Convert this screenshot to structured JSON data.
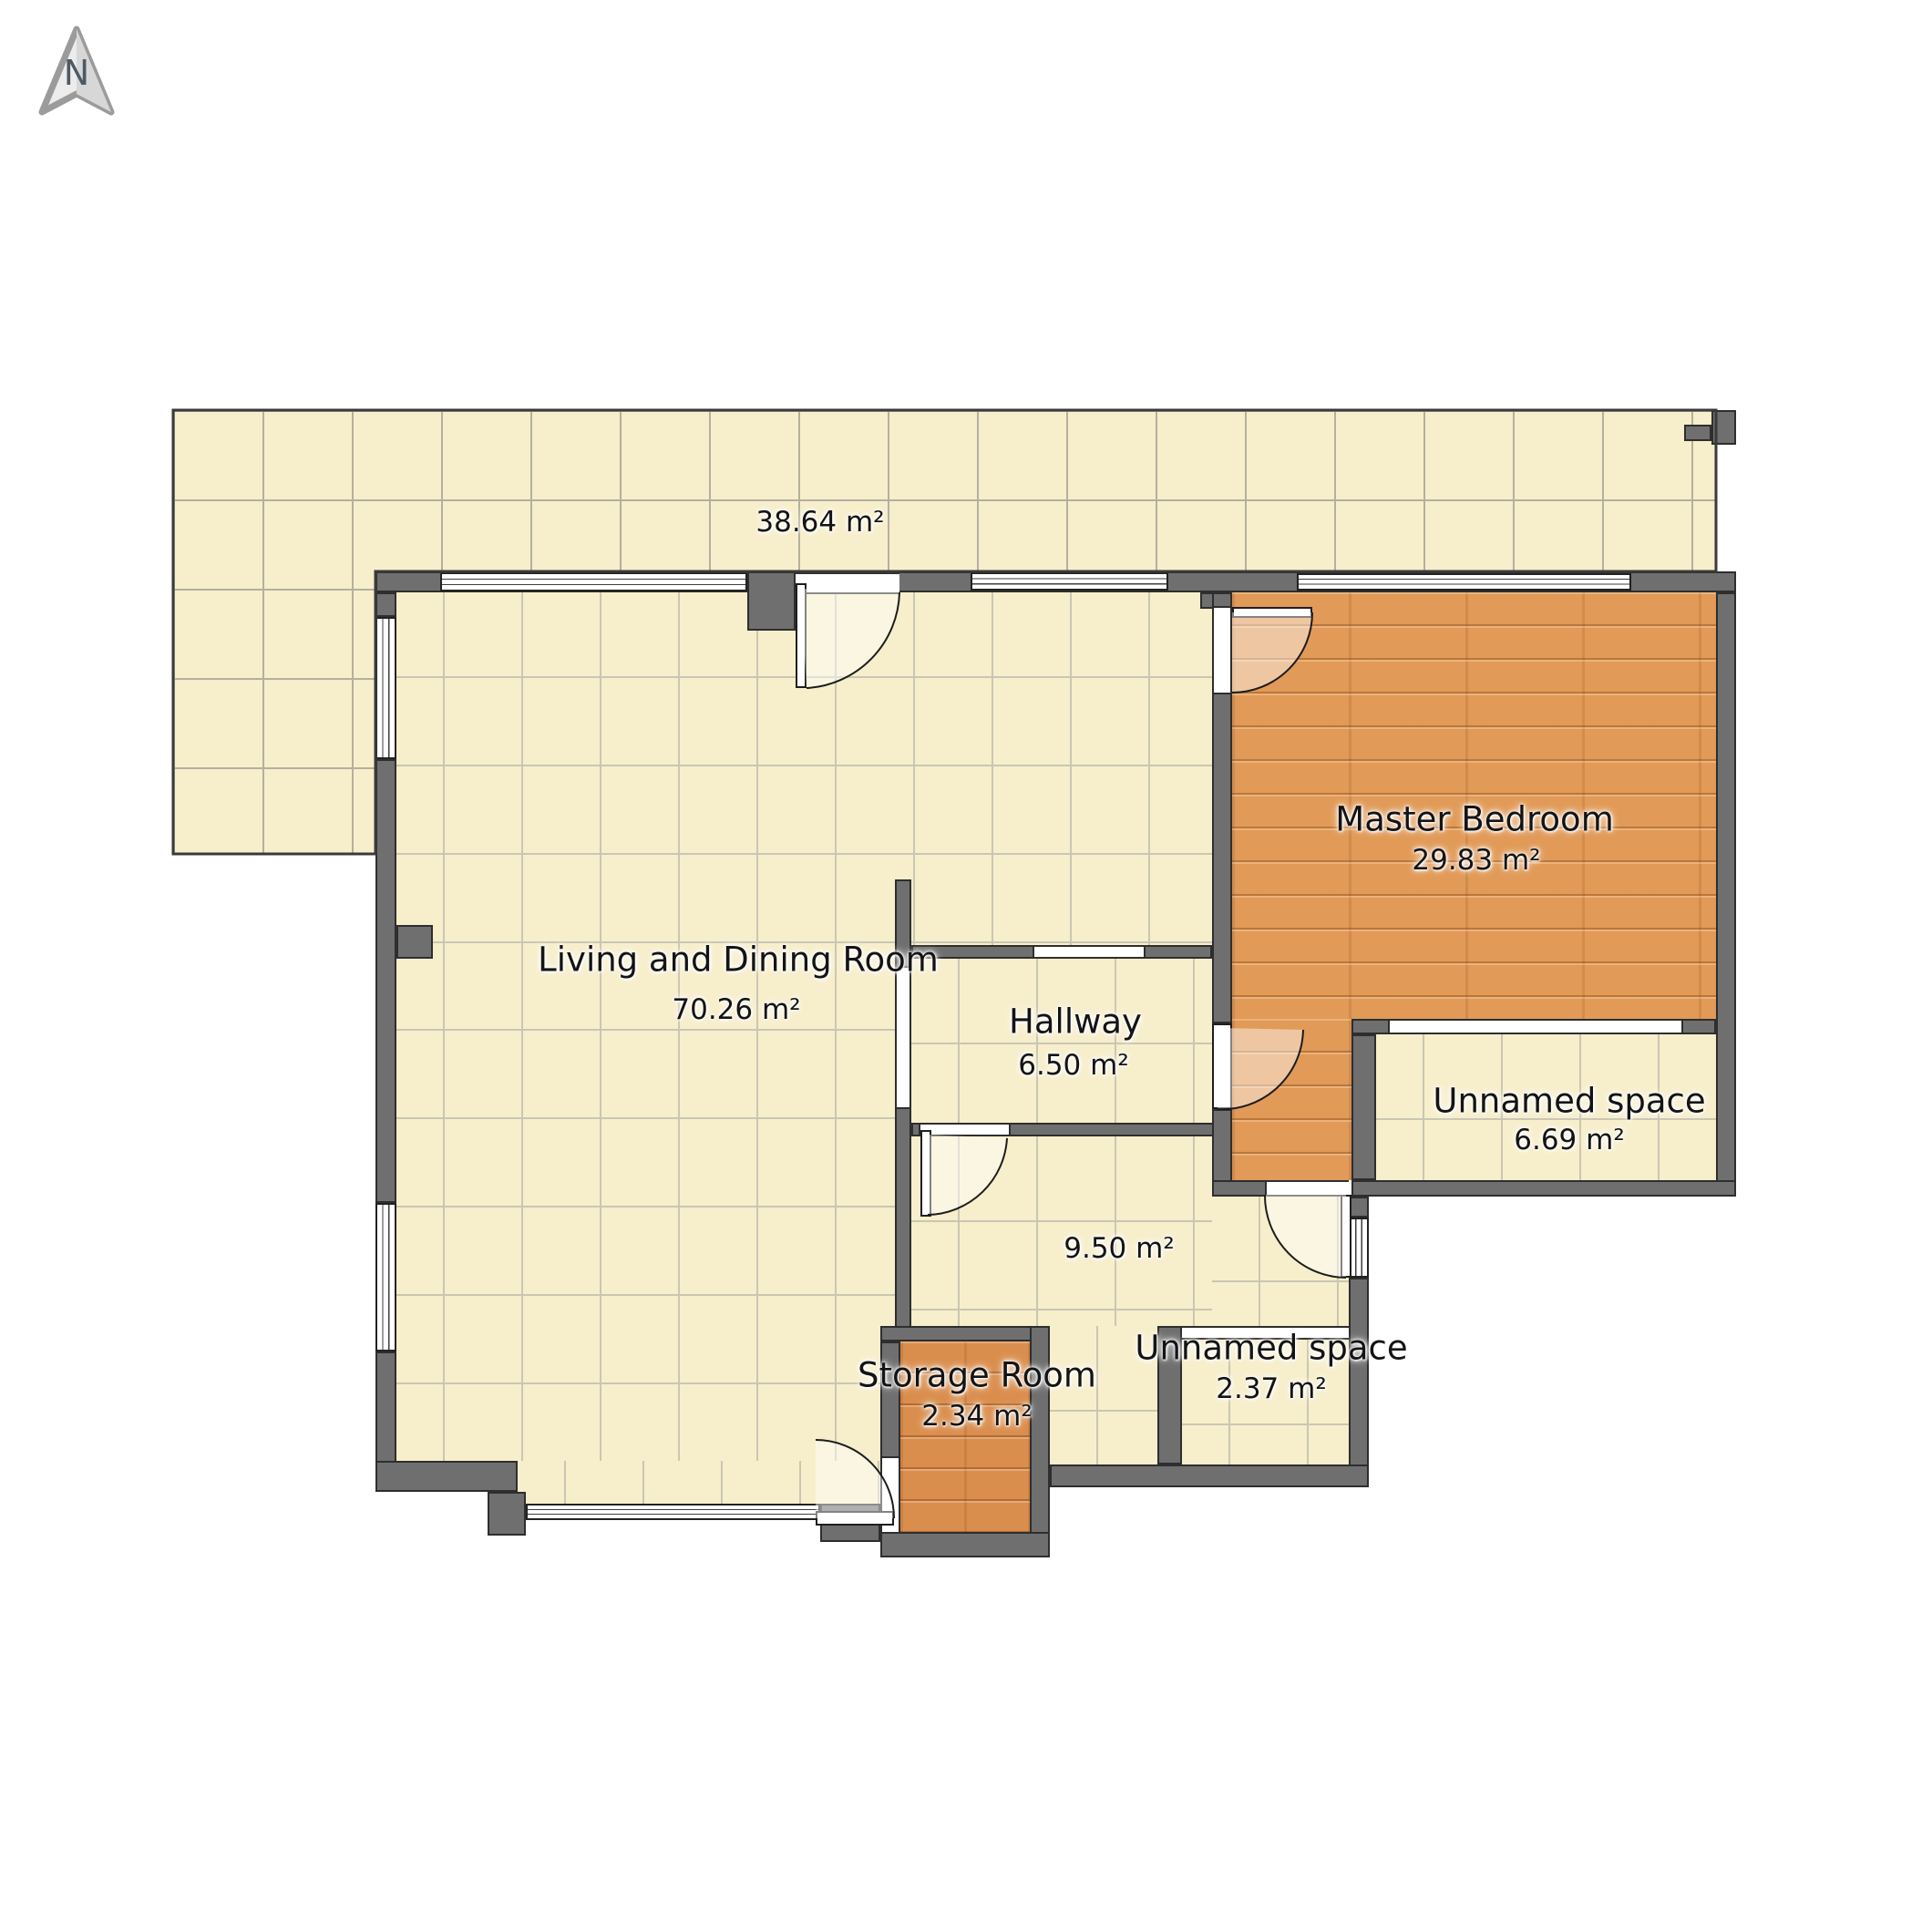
{
  "compass": {
    "label": "N"
  },
  "rooms": {
    "terrace": {
      "name": "",
      "area": "38.64 m²"
    },
    "living": {
      "name": "Living and Dining Room",
      "area": "70.26 m²"
    },
    "master": {
      "name": "Master Bedroom",
      "area": "29.83 m²"
    },
    "hallway": {
      "name": "Hallway",
      "area": "6.50 m²"
    },
    "unnamed_right": {
      "name": "Unnamed space",
      "area": "6.69 m²"
    },
    "bath": {
      "name": "",
      "area": "9.50 m²"
    },
    "storage": {
      "name": "Storage Room",
      "area": "2.34 m²"
    },
    "unnamed_bottom": {
      "name": "Unnamed space",
      "area": "2.37 m²"
    }
  },
  "colors": {
    "wall": "#6f6f6f",
    "wall_outline": "#2e2e2e",
    "tile_floor": "#f7eecb",
    "wood_floor": "#e19a57",
    "storage_wood_floor": "#da8e4e"
  }
}
